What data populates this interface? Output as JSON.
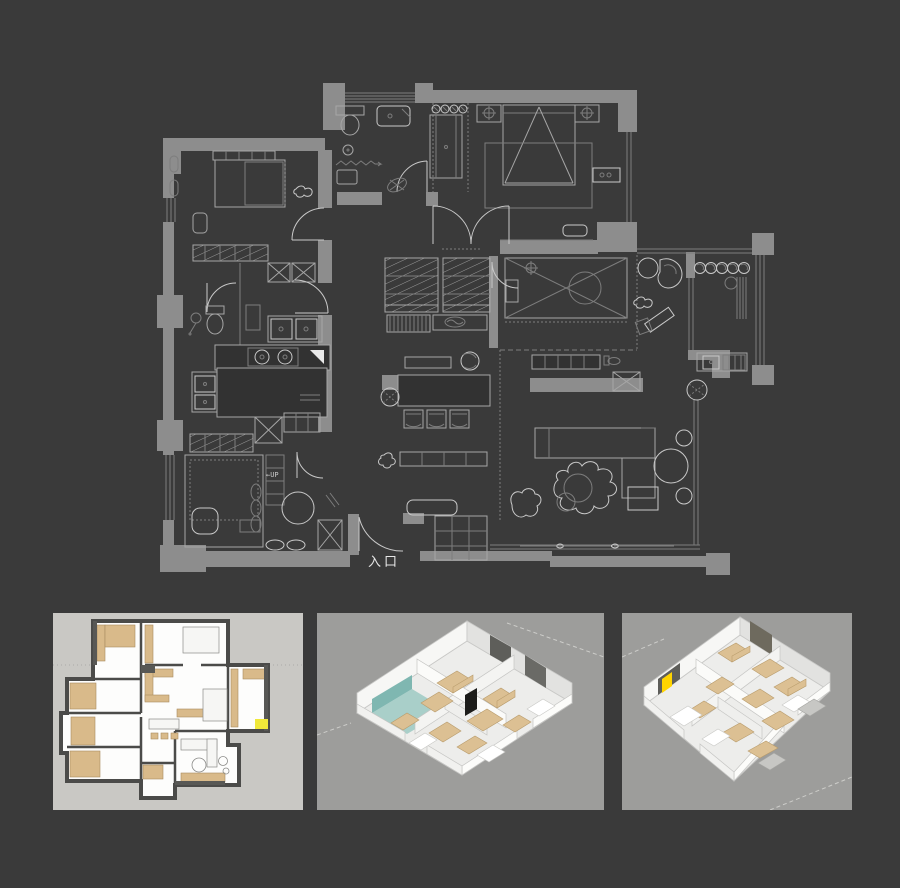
{
  "page": {
    "background": "#3a3a3a"
  },
  "floor_plan": {
    "entrance_label": "入口",
    "up_label": "←UP",
    "colors": {
      "background": "#3a3a3a",
      "wall": "#8d8d8d",
      "line": "#a6a6a6",
      "bright": "#c9c9c9",
      "faint": "#7d7d7d",
      "text": "#e6e6e6"
    }
  },
  "thumbnails": [
    {
      "id": "top-down-render",
      "background": "#c9c8c4",
      "floor": "#fdfdfc",
      "wall": "#4b4b49",
      "furniture": "#d9ba8a",
      "accent": "#f0e83a"
    },
    {
      "id": "isometric-render-a",
      "background": "#9d9d9b",
      "wall": "#f7f7f5",
      "wall_shade": "#e2e2e0",
      "floor": "#ededeb",
      "furniture": "#dcc093",
      "accent": "#9ccac5"
    },
    {
      "id": "isometric-render-b",
      "background": "#9d9d9b",
      "wall": "#f7f7f5",
      "wall_shade": "#e2e2e0",
      "floor": "#ededeb",
      "furniture": "#dcc093",
      "accent": "#ffd400"
    }
  ]
}
